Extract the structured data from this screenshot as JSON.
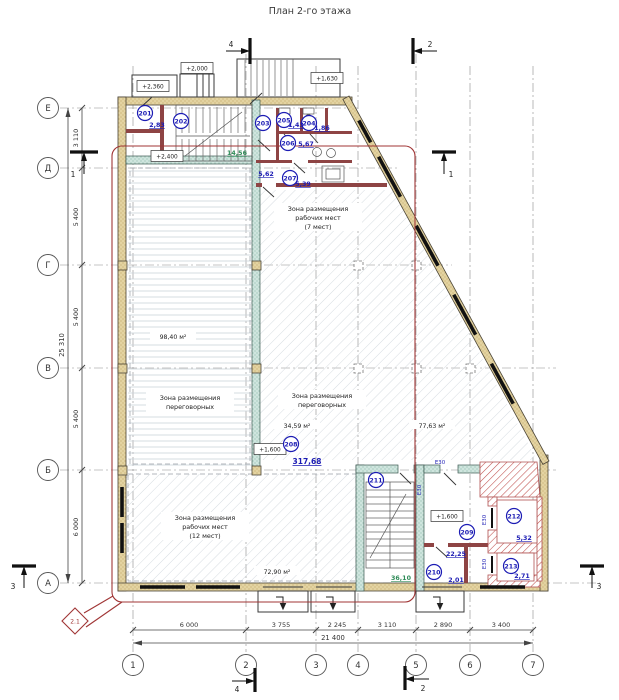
{
  "title": "План 2-го этажа",
  "grid": {
    "columns": [
      "1",
      "2",
      "3",
      "4",
      "5",
      "6",
      "7"
    ],
    "rows": [
      "Е",
      "Д",
      "Г",
      "В",
      "Б",
      "А"
    ]
  },
  "dims": {
    "bottom": [
      "6 000",
      "3 755",
      "2 245",
      "3 110",
      "2 890",
      "3 400"
    ],
    "bottom_total": "21 400",
    "left": [
      "3 110",
      "5 400",
      "5 400",
      "5 400",
      "6 000"
    ],
    "left_total": "25 310"
  },
  "sections": {
    "s1": "1",
    "s2": "2",
    "s3": "3",
    "s4": "4"
  },
  "elevations": {
    "canopy_left": "+2,360",
    "canopy_mid": "+2,000",
    "landing": "+2,400",
    "ext_stair": "+1,630",
    "hall": "+1,600",
    "stair": "+1,600"
  },
  "rooms": [
    {
      "number": "201",
      "area": "2,83"
    },
    {
      "number": "202",
      "area": "14,56"
    },
    {
      "number": "203",
      "area": "5,62"
    },
    {
      "number": "204",
      "area": "1,86"
    },
    {
      "number": "205",
      "area": "1,43"
    },
    {
      "number": "206",
      "area": "5,67"
    },
    {
      "number": "207",
      "area": "5,39"
    },
    {
      "number": "208",
      "area": "317,68"
    },
    {
      "number": "209",
      "area": "22,25"
    },
    {
      "number": "210",
      "area": "2,01"
    },
    {
      "number": "211",
      "area": "36,10"
    },
    {
      "number": "212",
      "area": "5,32"
    },
    {
      "number": "213",
      "area": "2,71"
    }
  ],
  "zones": {
    "left": {
      "l1": "Зона размещения",
      "l2": "переговорных",
      "area": "98,40 м²"
    },
    "work7": {
      "l1": "Зона размещения",
      "l2": "рабочих мест",
      "l3": "(7 мест)"
    },
    "meeting": {
      "l1": "Зона размещения",
      "l2": "переговорных",
      "area": "34,59 м²"
    },
    "open": {
      "area": "77,63 м²"
    },
    "work12": {
      "l1": "Зона размещения",
      "l2": "рабочих мест",
      "l3": "(12 мест)",
      "area": "72,90 м²"
    }
  },
  "fire_rating": "E30",
  "revision": {
    "marker": "2.1"
  },
  "colors": {
    "wall_fill": "#e3d3a1",
    "stair_wall": "#cfe5de",
    "shaft_hatch": "#c0504d",
    "badge_blue": "#1c1cb4",
    "green": "#2e8b57",
    "revision_red": "#a03535",
    "floor_hatch": "#ccd3da"
  }
}
